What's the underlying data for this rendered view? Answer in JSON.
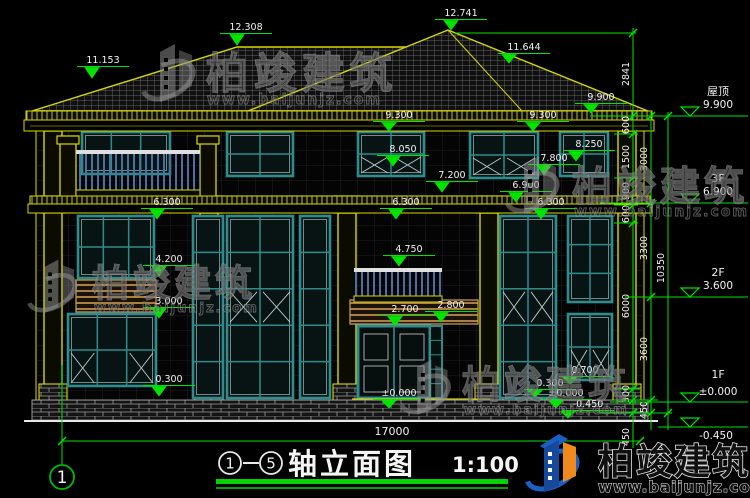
{
  "title_block": {
    "axis_from": "1",
    "dash": "—",
    "axis_to": "5",
    "name": "轴立面图",
    "scale": "1:100"
  },
  "axis_bubble": "1",
  "overall_dim": "17000",
  "elevation_markers": [
    "11.153",
    "12.308",
    "12.741",
    "11.644",
    "9.900",
    "9.300",
    "9.300",
    "8.050",
    "8.250",
    "7.800",
    "7.200",
    "6.900",
    "6.300",
    "6.300",
    "6.300",
    "4.750",
    "4.200",
    "3.000",
    "2.700",
    "2.800",
    "0.300",
    "0.700",
    "0.300",
    "±0.000",
    "±0.000",
    "-0.450"
  ],
  "right_levels": [
    {
      "label": "屋顶",
      "value": "9.900"
    },
    {
      "label": "3F",
      "value": "6.900"
    },
    {
      "label": "2F",
      "value": "3.600"
    },
    {
      "label": "1F",
      "value": "±0.000"
    },
    {
      "label": "",
      "value": "-0.450"
    }
  ],
  "dim_chains": {
    "inner": [
      "2841",
      "600",
      "1500",
      "900",
      "600",
      "6000",
      "300",
      "450"
    ],
    "middle": [
      "3000",
      "3300",
      "3600",
      "450"
    ],
    "outer": [
      "10350"
    ]
  },
  "watermark": {
    "brand": "柏竣建筑",
    "url": "www.baijunjz.com"
  },
  "logo": {
    "brand": "柏竣建筑",
    "url": "www.baijunjz.com"
  },
  "colors": {
    "dimension_green": "#00e400",
    "text_white": "#f2f2f2",
    "line_yellow": "#d8d800",
    "window_teal": "#2f8c8c",
    "logo_blue": "#1b5fc2",
    "logo_orange": "#f08a1d"
  }
}
